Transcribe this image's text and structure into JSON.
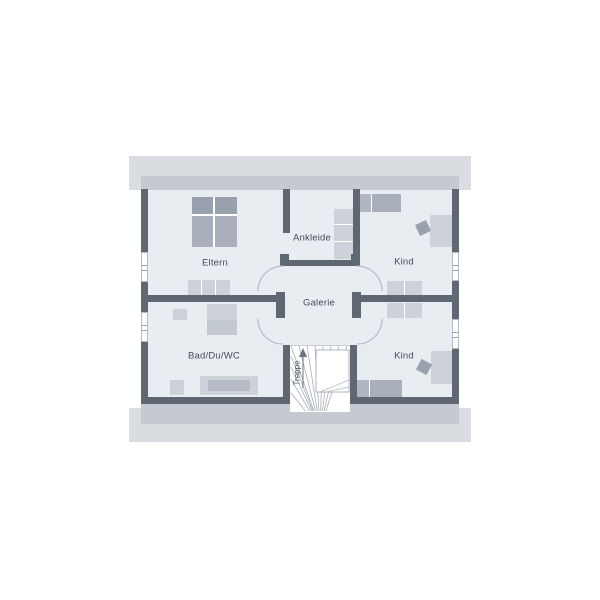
{
  "rooms": {
    "eltern": {
      "label": "Eltern"
    },
    "ankleide": {
      "label": "Ankleide"
    },
    "kind_top": {
      "label": "Kind"
    },
    "galerie": {
      "label": "Galerie"
    },
    "bad": {
      "label": "Bad/Du/WC"
    },
    "kind_bottom": {
      "label": "Kind"
    },
    "treppe": {
      "label": "Treppe"
    }
  },
  "colors": {
    "wall": "#5f6772",
    "floor": "#e9ecf1",
    "eave_outer": "#d9dce1",
    "eave_inner": "#c5cad2",
    "furn_light": "#cdd2d9",
    "furn_mid": "#a9b0bc",
    "furn_dark": "#99a1ae",
    "line": "#a8afb9",
    "text": "#454d59"
  }
}
